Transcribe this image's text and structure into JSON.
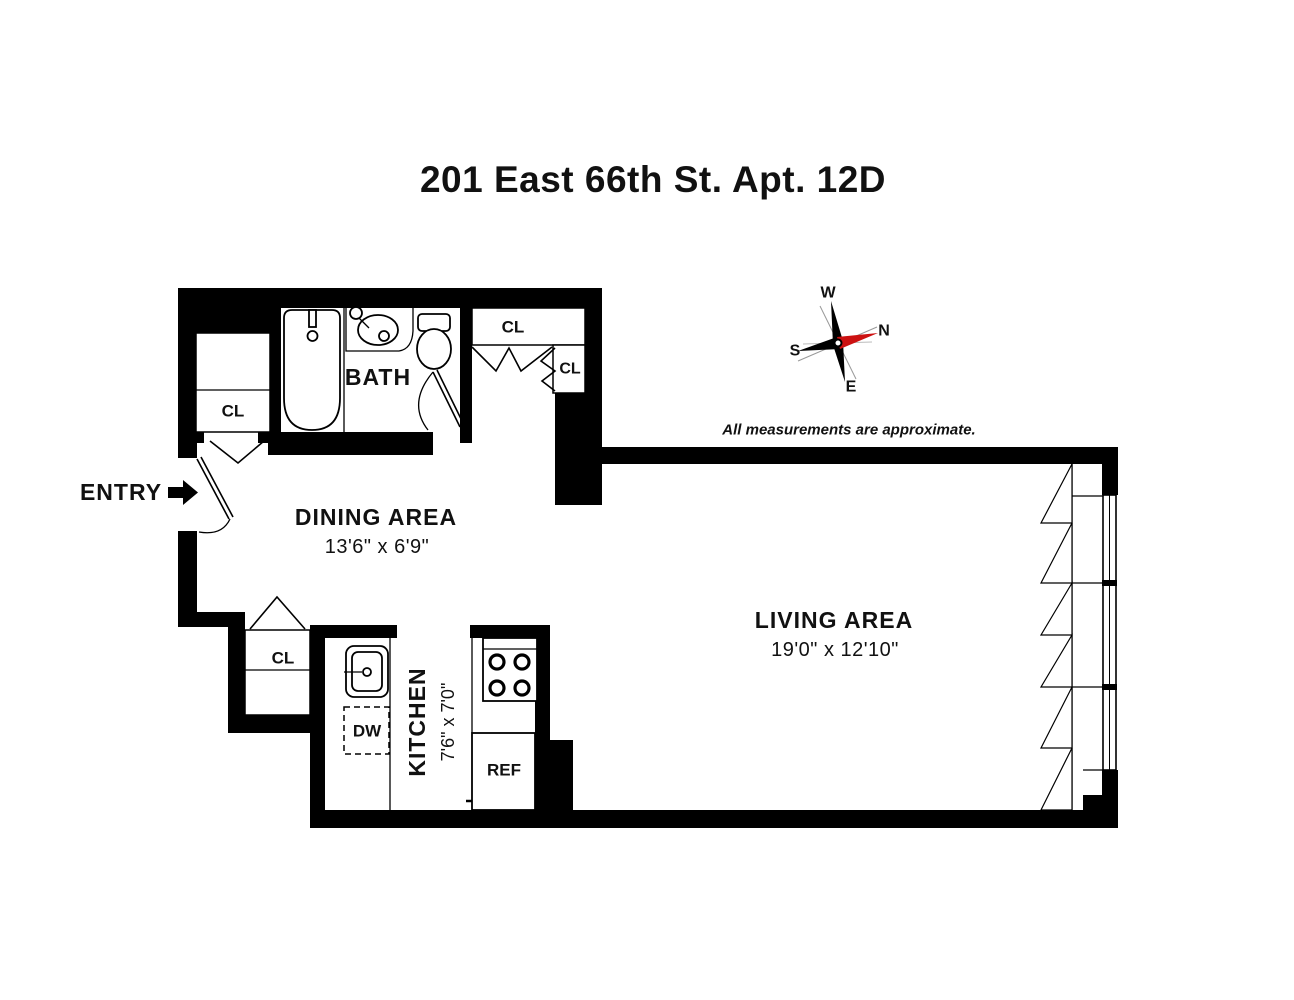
{
  "title": "201 East 66th St. Apt. 12D",
  "disclaimer": "All measurements are approximate.",
  "compass": {
    "west": "W",
    "north": "N",
    "south": "S",
    "east": "E",
    "north_color": "#cc1111"
  },
  "entry": {
    "label": "ENTRY"
  },
  "rooms": {
    "dining": {
      "name": "DINING AREA",
      "dims": "13'6\" x 6'9\""
    },
    "living": {
      "name": "LIVING AREA",
      "dims": "19'0\" x 12'10\""
    },
    "kitchen": {
      "name": "KITCHEN",
      "dims": "7'6\" x 7'0\""
    },
    "bath": {
      "name": "BATH"
    }
  },
  "closets": {
    "entry_closet": "CL",
    "hall_closet": "CL",
    "hall_closet_small": "CL",
    "dining_closet": "CL"
  },
  "appliances": {
    "dishwasher": "DW",
    "refrigerator": "REF"
  }
}
